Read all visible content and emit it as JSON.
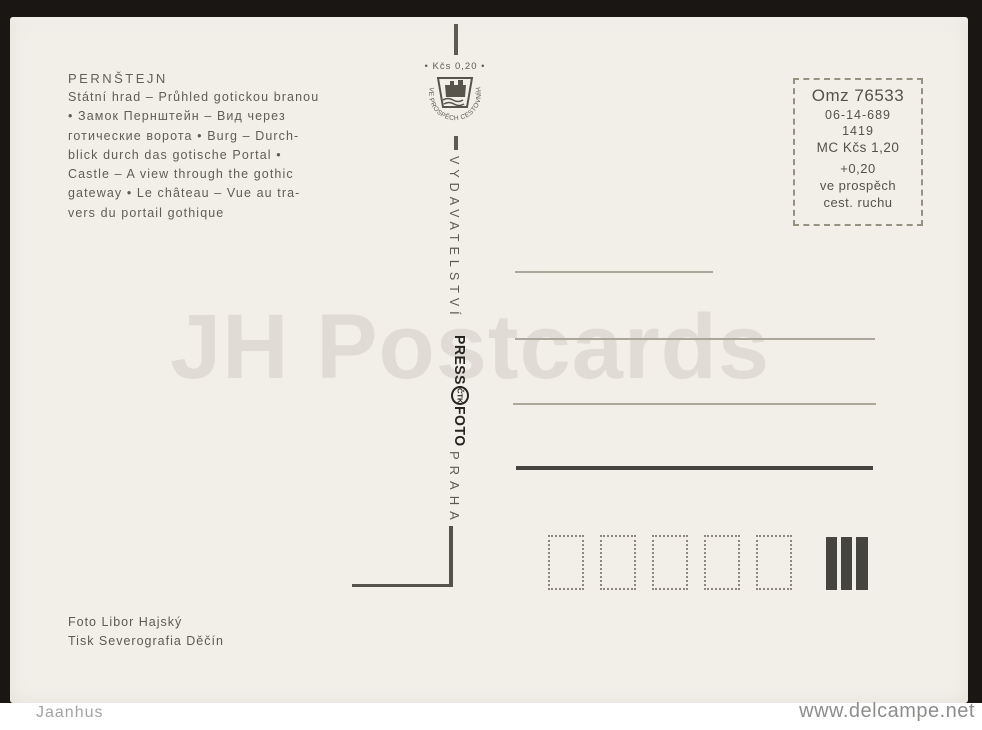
{
  "card": {
    "title": "PERNŠTEJN",
    "description_lines": [
      "Státní hrad – Průhled  gotickou branou",
      "• Замок Пернштейн – Вид через",
      "готические ворота • Burg – Durch-",
      "blick durch das gotische Portal •",
      "Castle – A view through the gothic",
      "gateway • Le château – Vue au tra-",
      "vers du portail gothique"
    ],
    "stamp": {
      "value_line": "• Kčs  0,20 •",
      "ring_text": "VE PROSPĚCH CESTOVNÍHO RUCHU",
      "publisher_vertical": "VYDAVATELSTVÍ",
      "logo_press": "PRESS",
      "logo_ctk": "ČTK",
      "logo_foto": "FOTO",
      "city_vertical": "PRAHA"
    },
    "price_box": {
      "code": "Omz 76533",
      "number": "06-14-689",
      "year": "1419",
      "price": "MC Kčs 1,20",
      "surcharge": "+0,20",
      "purpose_1": "ve prospěch",
      "purpose_2": "cest. ruchu"
    },
    "credits": {
      "photo": "Foto Libor Hajský",
      "print": "Tisk Severografia Děčín"
    }
  },
  "watermark": "JH Postcards",
  "footer": {
    "seller": "Jaanhus",
    "site": "www.delcampe.net"
  },
  "colors": {
    "card_background": "#f2efe9",
    "scan_border": "#191613",
    "ink": "#5d5a52",
    "address_line": "#aba89b",
    "heavy_line": "#45433d",
    "watermark": "#e3e1da"
  }
}
